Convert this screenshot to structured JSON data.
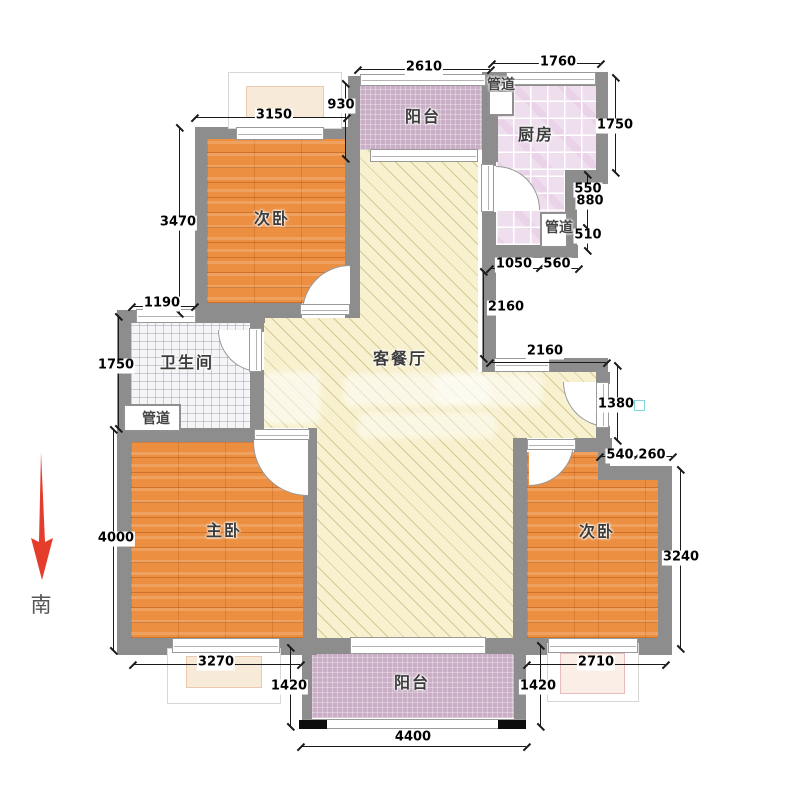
{
  "title": "apartment-floor-plan",
  "compass": {
    "south_label": "南"
  },
  "rooms": {
    "bedroom_top": "次卧",
    "bedroom_master": "主卧",
    "bedroom_right": "次卧",
    "balcony_top": "阳台",
    "balcony_bottom": "阳台",
    "kitchen": "厨房",
    "bathroom": "卫生间",
    "living_dining": "客餐厅",
    "duct_top": "管道",
    "duct_right": "管道",
    "duct_left": "管道"
  },
  "dims": {
    "top_2610": "2610",
    "top_1760": "1760",
    "top_930": "930",
    "top_3150": "3150",
    "right_1750": "1750",
    "right_550": "550",
    "right_880": "880",
    "right_510": "510",
    "right_1050": "1050",
    "right_560": "560",
    "right_2160_v": "2160",
    "right_2160_h": "2160",
    "right_1380": "1380",
    "right_540": "540",
    "right_260": "260",
    "right_3240": "3240",
    "left_3470": "3470",
    "left_1190": "1190",
    "left_1750": "1750",
    "left_4000": "4000",
    "bottom_3270": "3270",
    "bottom_1420_left": "1420",
    "bottom_4400": "4400",
    "bottom_1420_right": "1420",
    "bottom_2710": "2710"
  },
  "colors": {
    "wall": "#8d8d8d",
    "wood_floor": "#ec8f41",
    "living_floor": "#f8f1d0",
    "kitchen_floor": "#efdfee",
    "bathroom_floor": "#f5f5f7",
    "balcony_floor": "#c9aec6",
    "dimension_text": "#000000",
    "south_arrow": "#e43d2b",
    "accent_square": "#84d5dc"
  }
}
